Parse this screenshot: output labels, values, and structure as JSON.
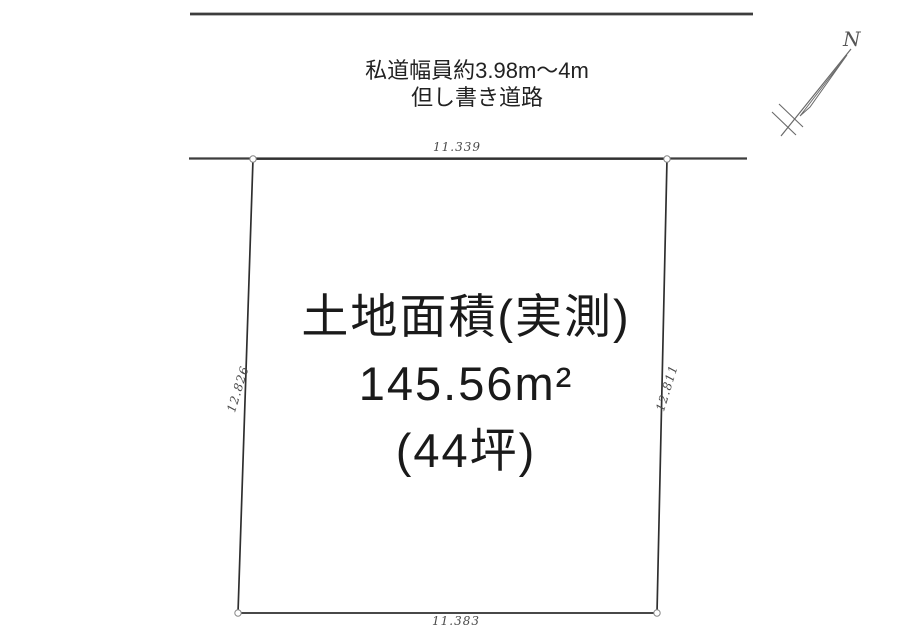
{
  "diagram_title": "land-plot-survey-drawing",
  "road": {
    "note_line1": "私道幅員約3.98m〜4m",
    "note_line2": "但し書き道路"
  },
  "north": {
    "label": "N"
  },
  "plot": {
    "area_line1": "土地面積(実測)",
    "area_line2": "145.56m²",
    "area_line3": "(44坪)",
    "dim_top": "11.339",
    "dim_bottom": "11.383",
    "dim_left": "12.826",
    "dim_right": "12.811"
  },
  "colors": {
    "background": "#ffffff",
    "road_line": "#3d3d3d",
    "boundary_line": "#2f2f2f",
    "dim_text": "#4a4a4a",
    "area_text": "#1a1a1a",
    "north_arrow": "#6a6a6a"
  }
}
